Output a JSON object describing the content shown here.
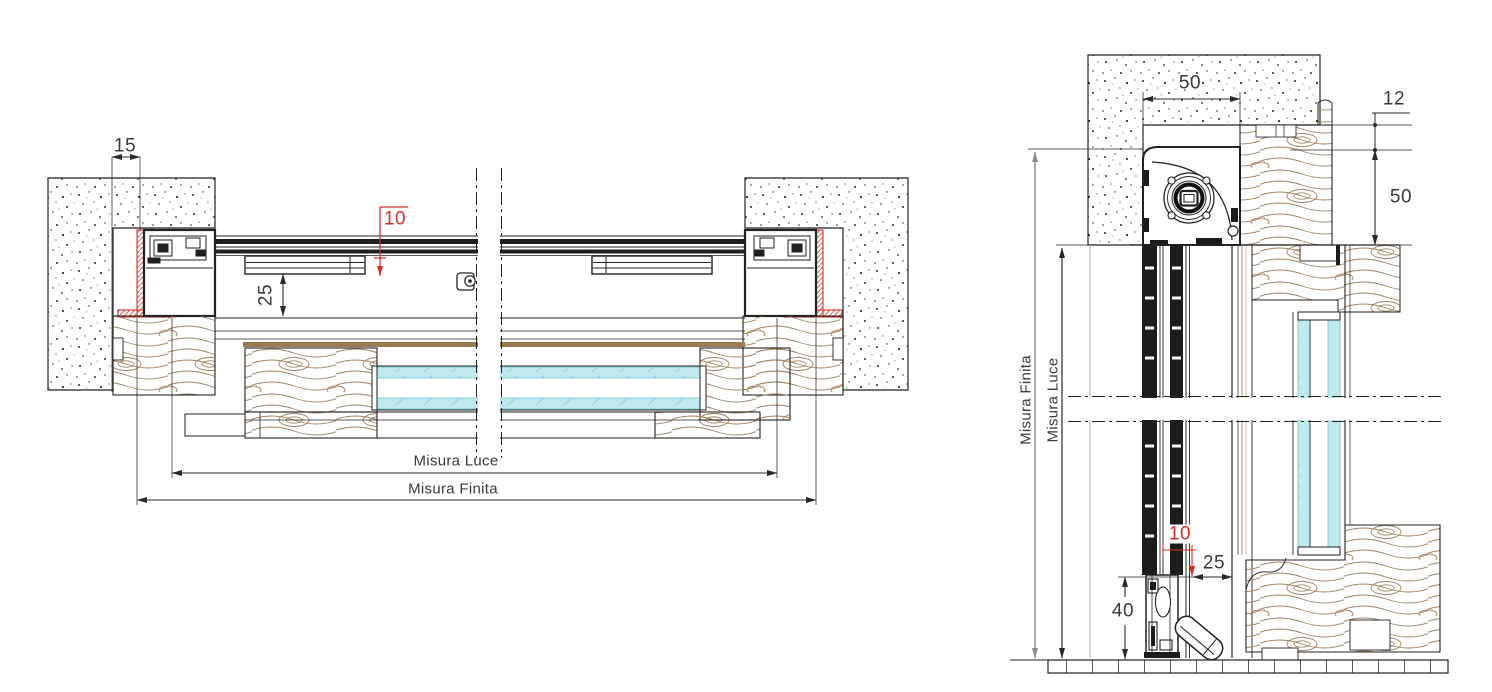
{
  "colors": {
    "accent_red": "#d63026",
    "glass_cyan": "#bfe9ee",
    "wood_grain": "#a5825f",
    "line": "#222222",
    "dim_gray": "#8a8a8a",
    "band_brown": "#9b7c50"
  },
  "left_view": {
    "dim_wall_gap": "15",
    "dim_screen_gap": "10",
    "dim_screen_depth": "25",
    "dim_clear_width": "Misura Luce",
    "dim_finished_width": "Misura Finita"
  },
  "right_view": {
    "dim_box_width": "50",
    "dim_reveal_offset": "12",
    "dim_box_height": "50",
    "dim_finished_height": "Misura Finita",
    "dim_clear_height": "Misura Luce",
    "dim_rail_gap": "10",
    "dim_rail_depth": "25",
    "dim_bar_height": "40"
  }
}
